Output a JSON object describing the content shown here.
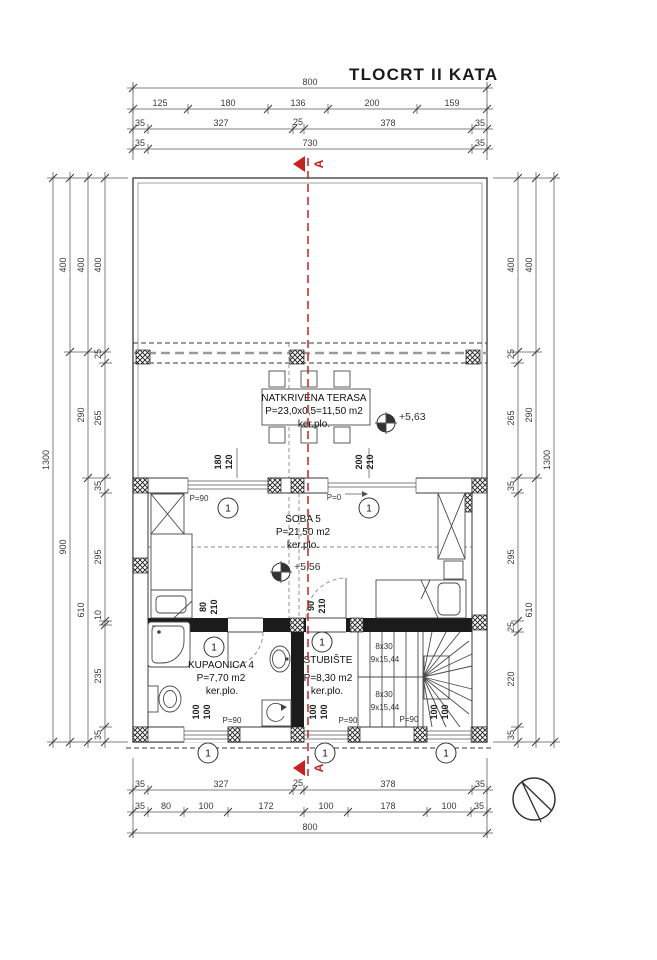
{
  "title": "TLOCRT II KATA",
  "section": {
    "label": "A"
  },
  "icons": {
    "north_arrow": "north-arrow-icon",
    "section_marker": "section-cut-arrow-icon",
    "elevation_marker": "benchmark-level-icon"
  },
  "colors": {
    "line": "#3a3a3a",
    "dimension": "#5a5a5a",
    "section_red": "#c52222",
    "paper": "#ffffff"
  },
  "dims_top": [
    [
      "800"
    ],
    [
      "125",
      "180",
      "136",
      "200",
      "159"
    ],
    [
      "35",
      "327",
      "25",
      "378",
      "35"
    ],
    [
      "35",
      "730",
      "35"
    ]
  ],
  "dims_bottom": [
    [
      "35",
      "327",
      "25",
      "378",
      "35"
    ],
    [
      "35",
      "80",
      "100",
      "172",
      "100",
      "178",
      "100",
      "35"
    ],
    [
      "800"
    ]
  ],
  "dims_left": [
    [
      "1300"
    ],
    [
      "400",
      "900"
    ],
    [
      "400",
      "290",
      "610"
    ],
    [
      "400",
      "25",
      "265",
      "35",
      "295",
      "10",
      "235",
      "35"
    ]
  ],
  "dims_right": [
    [
      "400",
      "25",
      "265",
      "35",
      "295",
      "25",
      "220",
      "35"
    ],
    [
      "400",
      "290",
      "610"
    ],
    [
      "1300"
    ]
  ],
  "rooms": {
    "terasa": {
      "name": "NATKRIVENA TERASA",
      "area": "P=23,0x0,5=11,50 m2",
      "floor": "ker.plo.",
      "level": "+5,63"
    },
    "soba": {
      "name": "SOBA 5",
      "area": "P=21,50 m2",
      "floor": "ker.plo.",
      "level": "+5,56"
    },
    "kupaonica": {
      "name": "KUPAONICA 4",
      "area": "P=7,70 m2",
      "floor": "ker.plo."
    },
    "stubiste": {
      "name": "STUBIŠTE",
      "area": "P=8,30 m2",
      "floor": "ker.plo.",
      "stair_run1": "8x30",
      "stair_run2": "9x15,44"
    }
  },
  "openings": {
    "window_terrace": {
      "w": "180",
      "h": "120",
      "parapet": "P=90"
    },
    "door_terrace": {
      "w": "200",
      "h": "210",
      "parapet": "P=0"
    },
    "door_kupaonica": {
      "w": "80",
      "h": "210"
    },
    "door_stubiste": {
      "w": "90",
      "h": "210"
    },
    "window_small": {
      "w": "100",
      "h": "100",
      "parapet": "P=90"
    },
    "position_marker": "1"
  }
}
